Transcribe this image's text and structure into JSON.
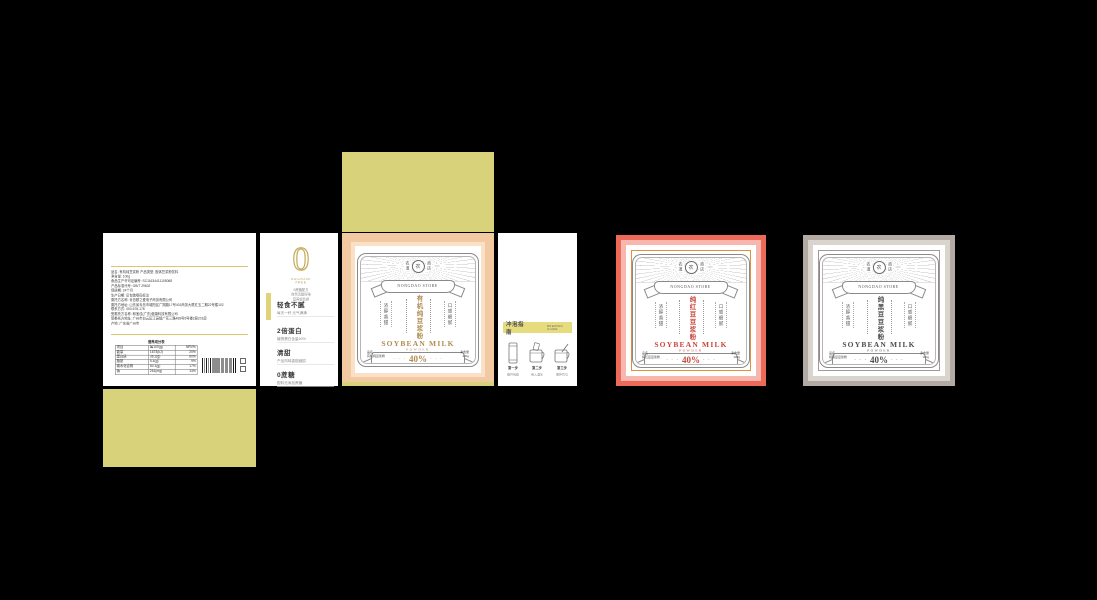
{
  "canvas": {
    "background": "#000000"
  },
  "colors": {
    "flap_yellow": "#d8d37a",
    "bar_yellow": "#e6dc7e",
    "peach_frame": "#f3c9a2",
    "peach_frame_light": "#fae0c7",
    "red_frame": "#ed6a58",
    "pink_frame": "#f8b7ae",
    "orange_line": "#df923d",
    "gray_frame": "#b3aaa3",
    "gray_frame_light": "#dad4ce",
    "gold_accent": "#b08d52",
    "red_accent": "#c9473c",
    "dark_accent": "#4d4d4d"
  },
  "info_panel": {
    "lines": [
      "品名: 有机纯豆浆粉    产品类型: 固体豆浆粉饮料",
      "净含量: 100g",
      "食品生产许可证编号: SC11634411105068",
      "产品标准代号: GB/T 29602",
      "保质期: 24个月",
      "生产日期: 见包装喷码标注",
      "委托方名称: 青岛颐之爱电子商务有限公司",
      "委托方地址: 山东省青岛市城阳区广翔路17号401商务大厦红玉二期22号楼102",
      "联系方式: 400-678-176",
      "受委托方名称: 和宝佳(广东)健康科技有限公司",
      "受委托方地址: 广州市白云区江高镇广花三路468号5号楼2层201房",
      "产地: 广东省广州市"
    ],
    "nutrition": {
      "title": "营养成分表",
      "headers": [
        "项目",
        "每100(g)",
        "NRV%"
      ],
      "rows": [
        [
          "能量",
          "1673(kJ)",
          "20%"
        ],
        [
          "蛋白质",
          "36.2(g)",
          "60%"
        ],
        [
          "脂肪",
          "5.4(g)",
          "9%"
        ],
        [
          "碳水化合物",
          "50.1(g)",
          "17%"
        ],
        [
          "钠",
          "261(mg)",
          "14%"
        ]
      ]
    }
  },
  "selling_panel": {
    "zero": "0",
    "zero_sub": "SUCROSE FREE",
    "zero_lines": [
      "0蔗糖配方",
      "自然清甜好味",
      "营养轻负担"
    ],
    "items": [
      {
        "title": "轻食不腻",
        "desc": "每天一杯 元气满满"
      },
      {
        "title": "2倍蛋白",
        "desc": "植物蛋白含量40%"
      },
      {
        "title": "清甜",
        "desc": "产品风味香甜细腻"
      },
      {
        "title": "0蔗糖",
        "desc": "配料无添加蔗糖"
      }
    ]
  },
  "brew_panel": {
    "bar_title": "冲泡指南",
    "bar_en": "BREWING GUIDE",
    "steps": [
      {
        "label": "第一步",
        "desc": "撕开包装"
      },
      {
        "label": "第二步",
        "desc": "倒入温水"
      },
      {
        "label": "第三步",
        "desc": "搅拌均匀"
      }
    ]
  },
  "decor": {
    "dots": "· · ·"
  },
  "labels": [
    {
      "store_en": "NONGDAO STORE",
      "seal_left": "农道",
      "seal_center": "农",
      "seal_right": "商店",
      "title": "有机纯豆浆粉",
      "left_tag": "浓醇香甜",
      "right_tag": "口感细腻",
      "product_en": "SOYBEAN MILK",
      "product_en2": "POWDER",
      "percent": "40%",
      "percent_sub": "植物蛋白",
      "bottom_left_label": "品名",
      "bottom_left_value": "有机纯豆浆粉",
      "bottom_right_label": "净含量",
      "bottom_right_value": "100g",
      "accent": "#b08d52"
    },
    {
      "store_en": "NONGDAO STORE",
      "seal_left": "农道",
      "seal_center": "农",
      "seal_right": "商店",
      "title": "纯红豆豆浆粉",
      "left_tag": "浓醇香甜",
      "right_tag": "口感细腻",
      "product_en": "SOYBEAN MILK",
      "product_en2": "POWDER",
      "percent": "40%",
      "percent_sub": "植物蛋白",
      "bottom_left_label": "品名",
      "bottom_left_value": "纯红豆豆浆粉",
      "bottom_right_label": "净含量",
      "bottom_right_value": "100g",
      "accent": "#c9473c"
    },
    {
      "store_en": "NONGDAO STORE",
      "seal_left": "农道",
      "seal_center": "农",
      "seal_right": "商店",
      "title": "纯黑豆豆浆粉",
      "left_tag": "浓醇香甜",
      "right_tag": "口感细腻",
      "product_en": "SOYBEAN MILK",
      "product_en2": "POWDER",
      "percent": "40%",
      "percent_sub": "植物蛋白",
      "bottom_left_label": "品名",
      "bottom_left_value": "纯黑豆豆浆粉",
      "bottom_right_label": "净含量",
      "bottom_right_value": "100g",
      "accent": "#4d4d4d"
    }
  ]
}
